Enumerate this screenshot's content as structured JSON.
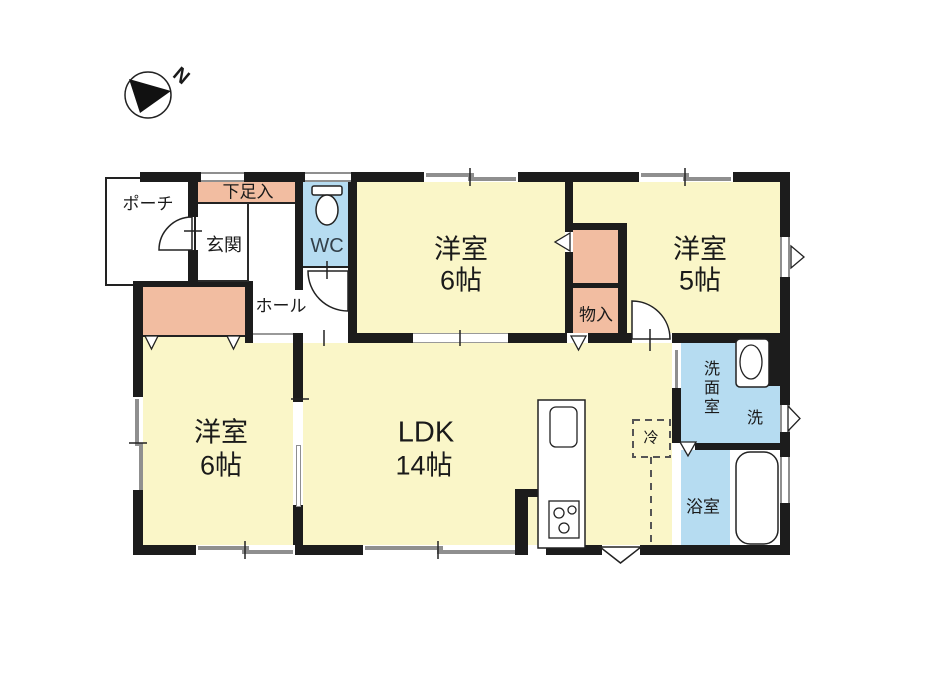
{
  "title": "1LDK+3room floor plan",
  "compass": {
    "n": "N"
  },
  "colors": {
    "room_yellow": "#faf6c8",
    "closet_salmon": "#f2bda1",
    "wet_blue": "#b6dcf1",
    "wall": "#1c1c1c",
    "window_gray": "#8f8f8f"
  },
  "rooms": {
    "porch": "ポーチ",
    "shoe_cabinet": "下足入",
    "entrance": "玄関",
    "wc": "WC",
    "hall": "ホール",
    "bedroom_top": {
      "name": "洋室",
      "size": "6帖"
    },
    "bedroom_right": {
      "name": "洋室",
      "size": "5帖"
    },
    "storage": "物入",
    "bedroom_left": {
      "name": "洋室",
      "size": "6帖"
    },
    "ldk": {
      "name": "LDK",
      "size": "14帖"
    },
    "refrigerator": "冷",
    "washroom": "洗面室",
    "washer": "洗",
    "bathroom": "浴室"
  }
}
